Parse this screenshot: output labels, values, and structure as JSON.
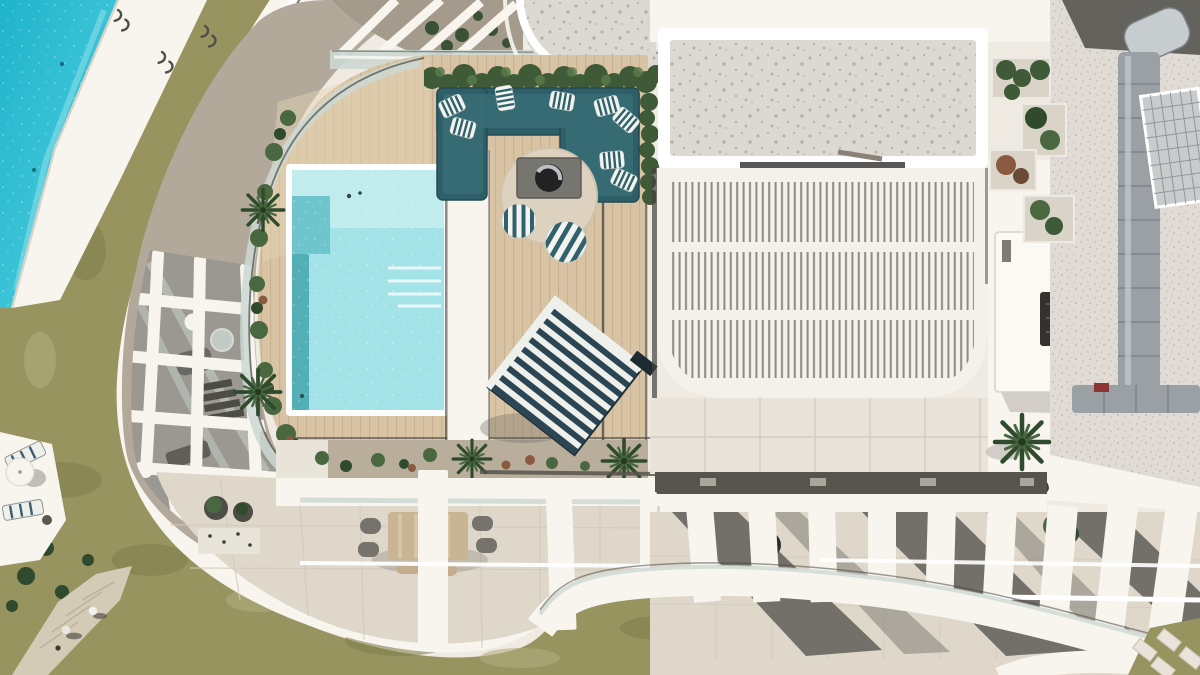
{
  "meta": {
    "title": "Aerial drone view of a modern penthouse rooftop terrace",
    "description": "Top-down aerial photograph of a luxury penthouse rooftop: private turquoise plunge pool on a timber deck, U-shaped teal lounge sofa with striped cushions around a fire-pit table, striped daybed, white louvered pergola with terrazzo roof slab, outdoor kitchen, gravel service roof with metal ducting, curved white balconies and colonnade fins, communal pool, lawn with a stone path, sun loungers and two people walking.",
    "width": 1200,
    "height": 675
  },
  "scene": {
    "elements": [
      {
        "name": "communal-pool",
        "label": "large shared pool, top-left"
      },
      {
        "name": "pool-deck-band",
        "label": "white deck beside communal pool"
      },
      {
        "name": "lawn",
        "label": "olive lawn wrapping left and bottom"
      },
      {
        "name": "garden-path",
        "label": "stone path with two people"
      },
      {
        "name": "sun-loungers",
        "label": "two loungers with white parasol, left edge"
      },
      {
        "name": "curved-balcony-band",
        "label": "sweeping white balcony edge"
      },
      {
        "name": "lower-terrace-lattice",
        "label": "white beam grid over lower terrace"
      },
      {
        "name": "plunge-pool",
        "label": "private turquoise pool on deck"
      },
      {
        "name": "timber-deck",
        "label": "light timber rooftop deck"
      },
      {
        "name": "lounge-sofa",
        "label": "U-shaped teal sofa with striped pillows"
      },
      {
        "name": "fire-pit-table",
        "label": "square fire table on round rug"
      },
      {
        "name": "striped-daybed",
        "label": "rotated navy-striped daybed"
      },
      {
        "name": "hedge",
        "label": "clipped green hedge behind sofa"
      },
      {
        "name": "pergola",
        "label": "white louvered pergola roof"
      },
      {
        "name": "terrazzo-roof",
        "label": "speckled terrazzo roof slabs"
      },
      {
        "name": "outdoor-kitchen",
        "label": "white kitchen island with grill"
      },
      {
        "name": "service-roof",
        "label": "gravel roof with duct and grate"
      },
      {
        "name": "colonnade",
        "label": "white fins over lower balcony"
      },
      {
        "name": "dining-set",
        "label": "outdoor dining table and chairs"
      },
      {
        "name": "stepping-stones",
        "label": "diagonal pavers in grass corner"
      }
    ]
  },
  "colors": {
    "base": "#efeae2",
    "pool_large": "#33c5d8",
    "pool_large_deep": "#1fb4cb",
    "pool_large_light": "#8fe0ea",
    "pool_small": "#a3e3e7",
    "pool_small_shallow": "#c0ecee",
    "pool_small_mid": "#6fc5cc",
    "pool_small_deep": "#49a7b1",
    "deck_wood": "#d8c4a4",
    "deck_wood_light": "#e6d5b6",
    "deck_plank_line": "#c3ab87",
    "white_arch": "#f8f5ef",
    "white_bright": "#ffffff",
    "slope_roof": "#b3a99b",
    "slope_roof_dark": "#a59b8c",
    "gray_terrace": "#9b9891",
    "gray_shadow": "#605e58",
    "glass": "#ccd8d2",
    "rail_dark": "#4c4b46",
    "lawn": "#979460",
    "lawn_dark": "#7d7c4b",
    "lawn_dry": "#b3ab7e",
    "path_stone": "#d6cdb9",
    "hedge_green": "#3e5a37",
    "hedge_green_light": "#5a7a4a",
    "plant_green": "#4a6840",
    "plant_dark": "#2f4a2c",
    "plant_red": "#8a5a40",
    "sofa_teal": "#2e5f68",
    "sofa_teal_dark": "#234c54",
    "sofa_teal_light": "#3a6e78",
    "pillow_white": "#f3f4ef",
    "pillow_stripe": "#31626b",
    "rug_cream": "#ddd2bf",
    "firetable_gray": "#77756f",
    "firetable_ring": "#222222",
    "firetable_metal": "#b9bfc2",
    "daybed_navy": "#2c4553",
    "daybed_white": "#eef0ec",
    "bed_gravel": "#b9ae9c",
    "pebble_white": "#e9e4da",
    "terrazzo": "#dcd9d3",
    "terrazzo_dot": "#8f8c86",
    "louver_bg": "#f4f1eb",
    "louver_slat": "#8c8a84",
    "tile_floor": "#e9e3d9",
    "tile_line": "#d2cabb",
    "terrace_cream": "#ded7ca",
    "gutter_dark": "#56544d",
    "gutter_light": "#b9b4a8",
    "gravel_roof": "#e0dcd5",
    "dark_wedge": "#63625c",
    "duct_metal": "#9aa0a4",
    "duct_light": "#c7cccf",
    "duct_dark": "#7c8287",
    "grate": "#c9cccd",
    "grate_line": "#8d9295",
    "kitchen_white": "#fbf9f4",
    "grill_dark": "#33322f",
    "red_item": "#8e3434",
    "table_tan": "#c9b493",
    "chair_gray": "#75736c",
    "chair_tan": "#c2ae8e",
    "pot_dark": "#4e4c47",
    "people_light": "#e8e6e0",
    "people_dark": "#55534e",
    "umbrella_white": "#f6f4ee"
  }
}
